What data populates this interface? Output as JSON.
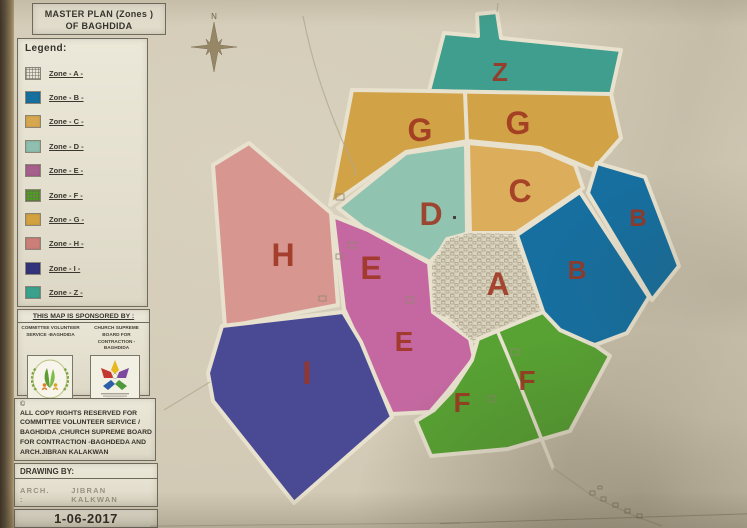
{
  "poster": {
    "title": {
      "line1": "MASTER PLAN (Zones )",
      "line2": "OF BAGHDIDA"
    },
    "legend": {
      "heading": "Legend:",
      "items": [
        {
          "label": "Zone - A -",
          "color": "#e8e5d8",
          "pattern": "grid"
        },
        {
          "label": "Zone - B -",
          "color": "#16709f",
          "pattern": "solid"
        },
        {
          "label": "Zone - C -",
          "color": "#d7a74f",
          "pattern": "solid"
        },
        {
          "label": "Zone - D -",
          "color": "#8fbfae",
          "pattern": "solid"
        },
        {
          "label": "Zone - E -",
          "color": "#a5608c",
          "pattern": "solid"
        },
        {
          "label": "Zone - F -",
          "color": "#4f9f22",
          "pattern": "grid"
        },
        {
          "label": "Zone - G -",
          "color": "#d2a23e",
          "pattern": "solid"
        },
        {
          "label": "Zone - H -",
          "color": "#cb7f78",
          "pattern": "solid"
        },
        {
          "label": "Zone - I -",
          "color": "#34347c",
          "pattern": "solid"
        },
        {
          "label": "Zone - Z -",
          "color": "#3aa18d",
          "pattern": "solid"
        }
      ]
    },
    "sponsor": {
      "heading": "THIS MAP IS SPONSORED BY :",
      "organizations": [
        {
          "name": "COMMITTEE VOLUNTEER SERVICE  -BAGHDIDA",
          "logo": "volunteer-committee-logo"
        },
        {
          "name": "CHURCH SUPREME BOARD FOR CONTRACTION - BAGHDIDA",
          "logo": "church-board-logo"
        }
      ]
    },
    "copyright": {
      "symbol": "©",
      "lines": [
        "ALL COPY RIGHTS RESERVED FOR",
        "COMMITTEE VOLUNTEER SERVICE  /",
        "BAGHDIDA  ,CHURCH SUPREME BOARD",
        "FOR CONTRACTION  -BAGHDEDA AND",
        "ARCH.JIBRAN KALAKWAN"
      ]
    },
    "drawing": {
      "heading": "DRAWING BY:",
      "prefix": "ARCH. :",
      "name": "JIBRAN KALKWAN"
    },
    "date": "1-06-2017",
    "compass": {
      "label": "N"
    }
  },
  "map": {
    "label_color": "#9e3420",
    "zones": [
      {
        "id": "Z",
        "letter": "Z",
        "color": "#3f9e8d"
      },
      {
        "id": "G",
        "letter": "G",
        "color": "#d2a246"
      },
      {
        "id": "C",
        "letter": "C",
        "color": "#dcad5a"
      },
      {
        "id": "D",
        "letter": "D",
        "color": "#90c3b0"
      },
      {
        "id": "H",
        "letter": "H",
        "color": "#d79790"
      },
      {
        "id": "E",
        "letter": "E",
        "color": "#c568a1"
      },
      {
        "id": "A",
        "letter": "A",
        "color": "#d9d2bd"
      },
      {
        "id": "B-west",
        "letter": "B",
        "color": "#166f9f"
      },
      {
        "id": "B-east",
        "letter": "B",
        "color": "#166f9f"
      },
      {
        "id": "I",
        "letter": "I",
        "color": "#4a4a94"
      },
      {
        "id": "F",
        "letter": "F",
        "color": "#57a233"
      }
    ]
  }
}
